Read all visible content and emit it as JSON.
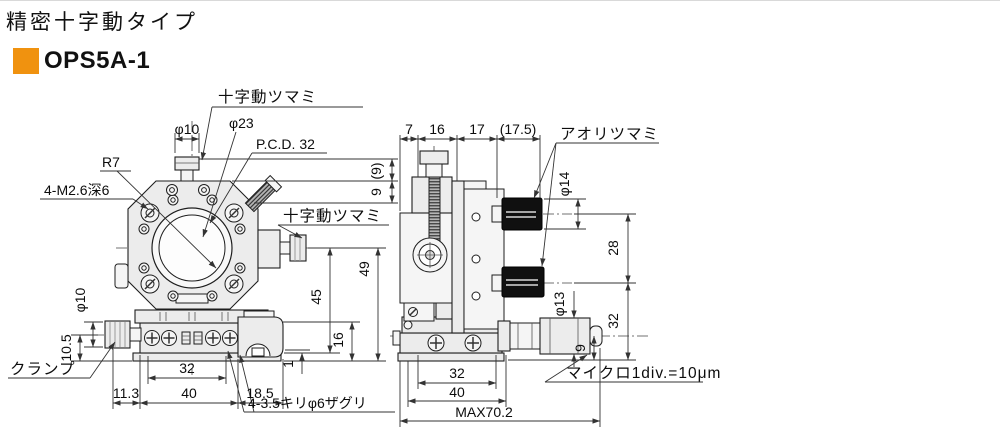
{
  "header": {
    "title": "精密十字動タイプ",
    "model": "OPS5A-1",
    "accent": "#f0920f"
  },
  "front_view": {
    "labels": {
      "top_knob": "十字動ツマミ",
      "side_knob": "十字動ツマミ",
      "aperture": "φ23",
      "pcd": "P.C.D. 32",
      "radius": "R7",
      "corner_screws": "4-M2.6深6",
      "knob_dia": "φ10",
      "clamp": "クランプ",
      "clamp_dia": "φ10",
      "counterbore": "4-3.5キリφ6ザグリ"
    },
    "dims": {
      "p9": "(9)",
      "h9": "9",
      "h49": "49",
      "h45": "45",
      "h16": "16",
      "h1": "1",
      "h105": "10.5",
      "b113": "11.3",
      "b32": "32",
      "b40": "40",
      "b185": "18.5"
    }
  },
  "side_view": {
    "labels": {
      "tilt_knob": "アオリツマミ",
      "knob_dia": "φ14",
      "mic_dia": "φ13",
      "micrometer": "マイクロ1div.=10μm"
    },
    "dims": {
      "w7": "7",
      "w16": "16",
      "w17": "17",
      "w175": "(17.5)",
      "h28": "28",
      "h32": "32",
      "h9": "9",
      "b32": "32",
      "b40": "40",
      "max": "MAX70.2"
    }
  }
}
